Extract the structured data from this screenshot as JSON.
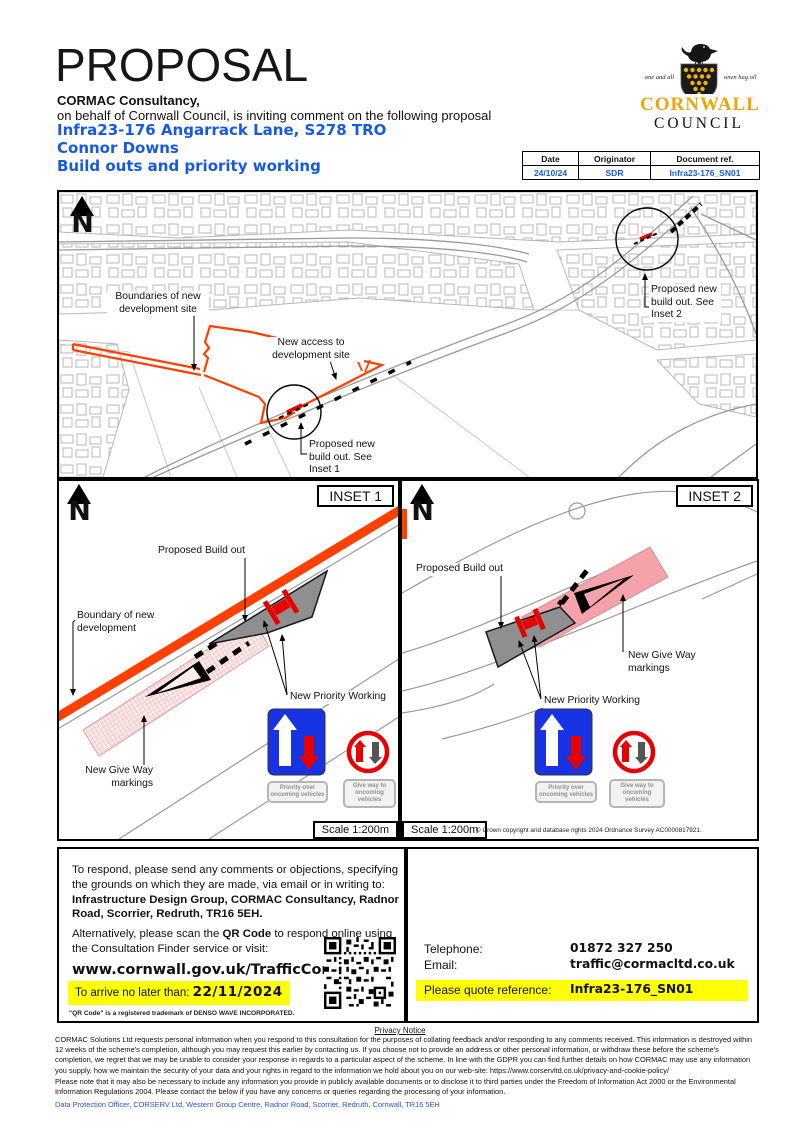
{
  "header": {
    "title": "PROPOSAL",
    "org": "CORMAC Consultancy,",
    "subtitle": "on behalf of Cornwall Council, is inviting comment on the following proposal",
    "scheme_ref_line": "Infra23-176 Angarrack Lane, S278 TRO",
    "scheme_location": "Connor Downs",
    "scheme_description": "Build outs and priority working",
    "accent_blue": "#1659e6"
  },
  "logo": {
    "motto_left": "one and all",
    "motto_right": "onen hag oll",
    "name_line1": "CORNWALL",
    "name_line2": "COUNCIL",
    "gold": "#efa50a"
  },
  "doc_table": {
    "headers": [
      "Date",
      "Originator",
      "Document ref."
    ],
    "values": [
      "24/10/24",
      "SDR",
      "Infra23-176_SN01"
    ]
  },
  "main_map": {
    "north_label": "N",
    "labels": {
      "boundaries": "Boundaries of new development site",
      "access": "New access to development site",
      "buildout1": "Proposed new build out. See Inset 1",
      "buildout2": "Proposed new build out. See Inset 2"
    },
    "boundary_color": "#ff4000"
  },
  "inset1": {
    "title": "INSET 1",
    "north_label": "N",
    "labels": {
      "buildout": "Proposed Build out",
      "boundary": "Boundary of new development",
      "giveway": "New Give Way markings",
      "priority": "New Priority Working"
    },
    "scale": "Scale 1:200m"
  },
  "inset2": {
    "title": "INSET 2",
    "north_label": "N",
    "labels": {
      "buildout": "Proposed Build out",
      "giveway": "New Give Way markings",
      "priority": "New Priority Working"
    },
    "scale": "Scale 1:200m",
    "copyright": "© Crown copyright and database rights 2024 Ordnance Survey AC0000817921."
  },
  "signs": {
    "priority_caption": "Priority over oncoming vehicles",
    "giveway_caption": "Give way to oncoming vehicles"
  },
  "response": {
    "para1": "To respond, please send any comments or objections, specifying the grounds on which they are made, via email or in writing to:",
    "address_bold": "Infrastructure Design Group, CORMAC Consultancy, Radnor Road, Scorrier, Redruth, TR16 5EH.",
    "para2_pre": "Alternatively, please scan the ",
    "para2_bold": "QR Code",
    "para2_post": " to respond online using the Consultation Finder service or visit:",
    "url": "www.cornwall.gov.uk/TrafficConsult",
    "deadline_label": "To arrive no later than: ",
    "deadline_date": "22/11/2024",
    "qr_trademark": "\"QR Code\" is a registered trademark of DENSO WAVE INCORPORATED.",
    "highlight": "#ffff00"
  },
  "contact": {
    "telephone_label": "Telephone:",
    "telephone": "01872 327 250",
    "email_label": "Email:",
    "email": "traffic@cormacltd.co.uk",
    "reference_label": "Please quote reference:",
    "reference": "Infra23-176_SN01"
  },
  "footer": {
    "privacy_title": "Privacy Notice",
    "para1": "CORMAC Solutions Ltd requests personal information when you respond to this consultation for the purposes of collating feedback and/or responding to any comments received. This information is destroyed within 12 weeks of the scheme's completion, although you may request this earlier by contacting us. If you choose not to provide an address or other personal information, or withdraw these before the scheme's completion, we regret that we may be unable to consider your response in regards to a particular aspect of the scheme. In line with the GDPR you can find further details on how CORMAC may use any information you supply, how we maintain the security of your data and your rights in regard to the information we hold about you on our web-site: https://www.corservltd.co.uk/privacy-and-cookie-policy/",
    "para2": "Please note that it may also be necessary to include any information you provide in publicly available documents or to disclose it to third parties under the Freedom of Information Act 2000 or the Environmental Information Regulations 2004. Please contact the below if you have any concerns or queries regarding the processing of your information.",
    "dpo_line": "Data Protection Officer, CORSERV Ltd, Western Group Centre, Radnor Road, Scorrier, Redruth, Cornwall, TR16 5EH"
  }
}
